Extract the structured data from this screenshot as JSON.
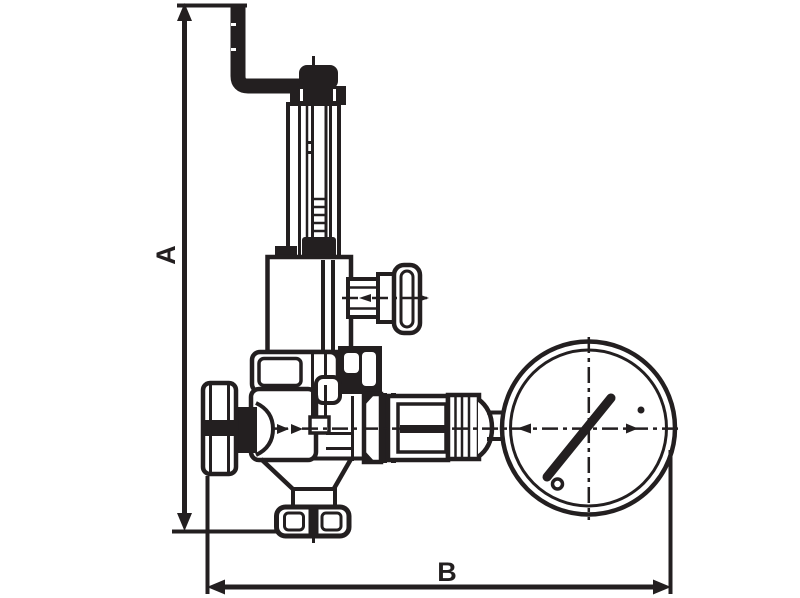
{
  "figure": {
    "type": "technical-dimension-drawing",
    "subject": "pressure-reducing-valve-with-pressure-gauge",
    "background_color": "#ffffff",
    "line_color": "#231f20",
    "dimensions": {
      "vertical_label": "A",
      "horizontal_label": "B"
    }
  }
}
